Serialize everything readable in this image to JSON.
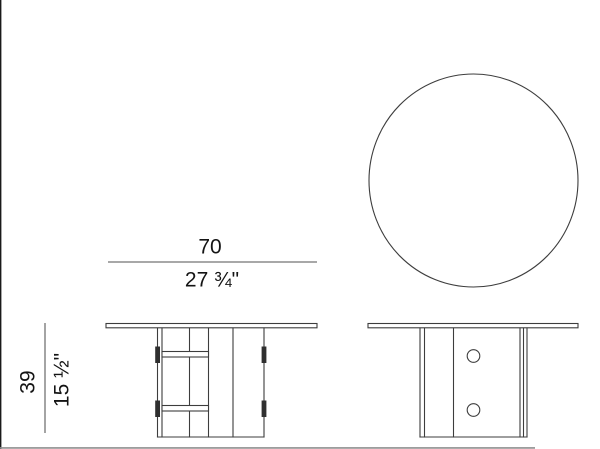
{
  "drawing": {
    "subject": "round-pedestal-table-technical-drawing",
    "views": {
      "top_view": "round tabletop seen from above",
      "front_view": "front elevation with pedestal panels and two stretcher rails",
      "side_view": "side elevation with two bolt holes"
    },
    "dimensions": {
      "width_cm": "70",
      "width_inches": "27 ¾\"",
      "height_cm": "39",
      "height_inches": "15 ½\""
    }
  },
  "colors": {
    "background": "#ffffff",
    "line": "#3d3d3d",
    "dim_line": "#8c8c8c",
    "dim_line_dark": "#5a5a5a",
    "text": "#141414",
    "connector": "#2f2f2f",
    "edge_left": "#1a1a1a",
    "edge_bottom": "#8f8f8f"
  }
}
